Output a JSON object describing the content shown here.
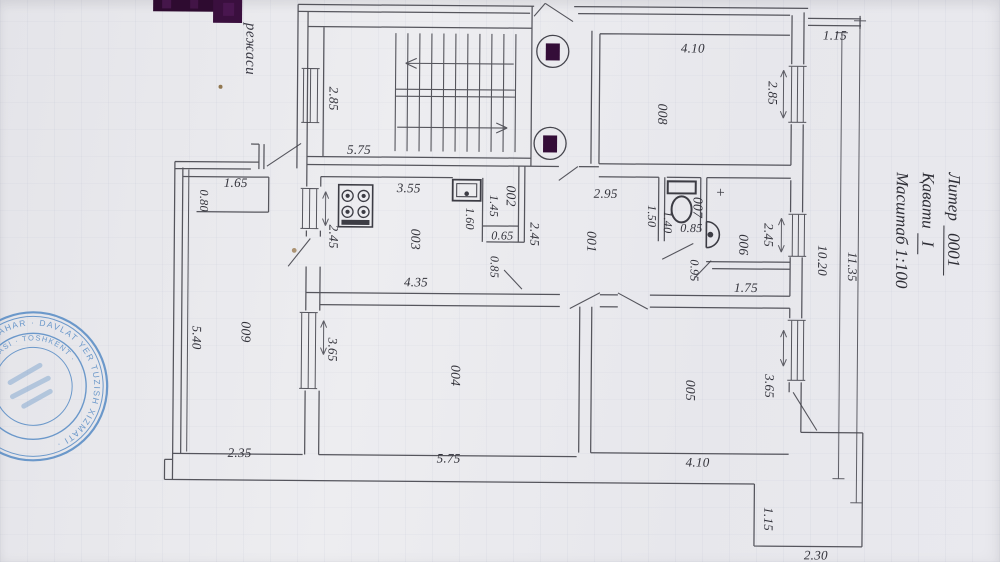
{
  "document": {
    "kind": "apartment floor plan scan",
    "caption_partial": "режаси",
    "title_block": {
      "liter_label": "Литер",
      "liter_value": "0001",
      "floor_label": "Қавати",
      "floor_value": "I",
      "scale_label": "Масштаб 1:100"
    },
    "stamp": {
      "color": "#4d85c2",
      "ring_text_outer": "· TOSHKENT SHAHAR · DAVLAT YER TUZISH XIZMATI ·",
      "ring_text_inner": "RESPUBLIKASI · TOSHKENT ·"
    }
  },
  "rooms": {
    "r001": "001",
    "r002": "002",
    "r003": "003",
    "r004": "004",
    "r005": "005",
    "r006": "006",
    "r007": "007",
    "r008": "008",
    "r009": "009"
  },
  "dims": {
    "stair_width": "5.75",
    "stair_window": "2.85",
    "r008_width": "4.10",
    "r008_window": "2.85",
    "top_right_balcony": "1.15",
    "right_inner_height": "10.20",
    "right_outer_height": "11.35",
    "kitchen_top": "3.55",
    "kitchen_window": "2.45",
    "kitchen_bottom": "4.35",
    "closet_height": "1.45",
    "sink_nook_height": "1.60",
    "nook_width": "0.65",
    "nook_gap": "0.85",
    "hall_height": "2.45",
    "hall_top": "2.95",
    "wc_height": "1.50",
    "wc_inner_height": "1.40",
    "wc_width": "0.85",
    "plus_mark": "+",
    "bath_window": "2.45",
    "bath_door_gap": "0.95",
    "bath_bottom": "1.75",
    "balcony_nook_width": "1.65",
    "balcony_nook_height": "0.80",
    "balcony_height": "5.40",
    "balcony_bottom": "2.35",
    "r004_window": "3.65",
    "r004_bottom": "5.75",
    "r005_window": "3.65",
    "r005_bottom": "4.10",
    "br_balcony_height": "1.15",
    "br_balcony_width": "2.30"
  }
}
